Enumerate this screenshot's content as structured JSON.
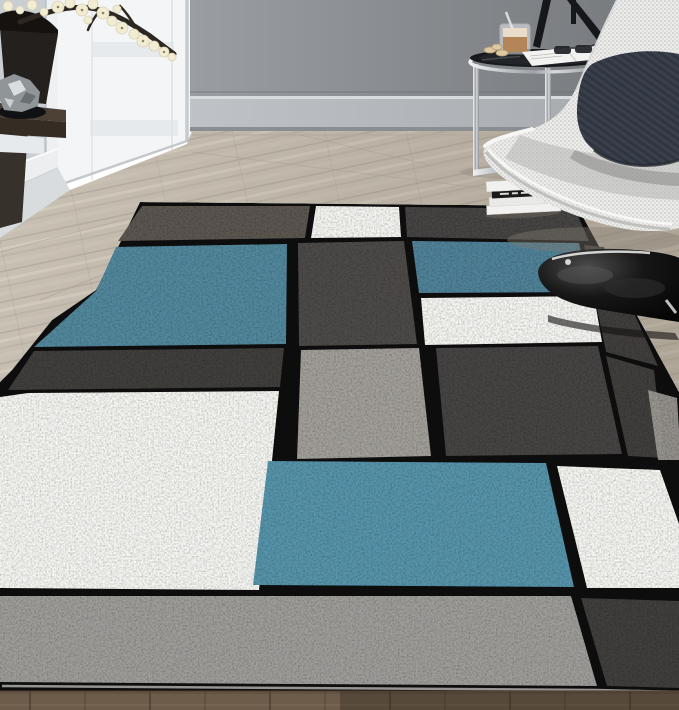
{
  "palette": {
    "wallLeft": "#c9ced3",
    "trim": "#eef0f2",
    "door": "#f3f5f6",
    "doorPanel": "#e7eaec",
    "baseboard": "#b4b8bc",
    "molding": "#eceef0",
    "console": "#37312b",
    "floorSeam": "#a89f93",
    "floorShadow": "#857d71",
    "shelfTop": "#4d4136",
    "shelfFront": "#352c24",
    "shelfBoard": "#e7eaec",
    "planter": "#23201d",
    "soil": "#15120f",
    "branch": "#2e2721",
    "blossom": "#f1ecd2",
    "blossomCore": "#8a8468",
    "silver": "#8f9598",
    "silverLight": "#d9dde0",
    "silverDark": "#6a6f72",
    "silverBase": "#101112",
    "tripod": "#15171a",
    "tableTop": "#17191c",
    "tableSheen": "#212428",
    "remote": "#222222",
    "coffee": "#b5855a",
    "foam": "#e9dcc8",
    "glass": "#e9ecee",
    "spoon": "#d8dadc",
    "cookie": "#dcc9a4",
    "cookieEdge": "#b49c72",
    "sunglasses": "#1e2125",
    "magazine": "#f2f2f0",
    "magazineText": "#b9b9b5",
    "bookPage": "#f1f1ef",
    "bookPage2": "#e9e9e7",
    "bookBand": "#191919",
    "bookText": "#d8d8d4",
    "pillow": "#353b46",
    "pedestal": "#070707",
    "rugTaupe": "#5d5751",
    "rugWhite": "#f6f6f3",
    "rugCharcoal": "#474544",
    "rugCharcoalDark": "#413f3d",
    "rugGrayCol": "#4e4b49",
    "rugBlue": "#53899e",
    "rugBlueMid": "#51839a",
    "rugBlueBright": "#5795ac",
    "rugGrayLight": "#a3a09a",
    "rugGrayBand": "#a09e9b",
    "rugBinding": "#b8b6b2",
    "rugBase": "#0c0c0c",
    "shadowStreak": "#121110"
  },
  "rug": {
    "style": "contemporary-boxes",
    "blocks": [
      {
        "name": "top-taupe"
      },
      {
        "name": "top-white"
      },
      {
        "name": "top-charcoal"
      },
      {
        "name": "mid-blue-left"
      },
      {
        "name": "mid-gray-column"
      },
      {
        "name": "mid-blue-right"
      },
      {
        "name": "mid-white-center"
      },
      {
        "name": "right-charcoal-wedge"
      },
      {
        "name": "right-charcoal-low"
      },
      {
        "name": "right-edge-gray"
      },
      {
        "name": "band-charcoal-left"
      },
      {
        "name": "center-gray-light"
      },
      {
        "name": "center-charcoal-large"
      },
      {
        "name": "bottom-white-large"
      },
      {
        "name": "bottom-blue-large"
      },
      {
        "name": "bottom-white-right"
      },
      {
        "name": "front-gray-band"
      },
      {
        "name": "front-charcoal-corner"
      }
    ]
  },
  "objects": {
    "room": [
      "wall",
      "door",
      "baseboard",
      "wood-floor",
      "dark-floor-strip"
    ],
    "furniture": [
      "floating-shelf",
      "planter",
      "blossom-branch",
      "silver-bowl",
      "side-table",
      "tripod-lamp",
      "coffee-glass",
      "cookies",
      "sunglasses",
      "magazine",
      "books-stack",
      "lounge-chair",
      "pillow",
      "pedestal-base",
      "area-rug"
    ]
  }
}
